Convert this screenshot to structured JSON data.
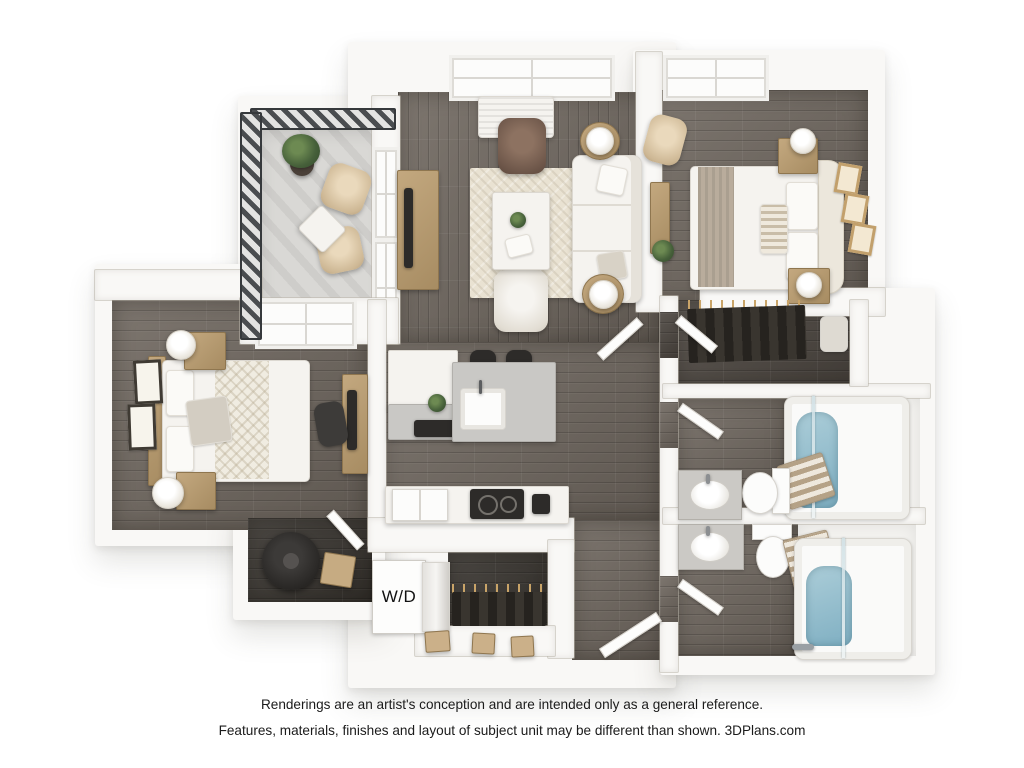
{
  "floor_plan": {
    "type": "3d-apartment-floor-plan-rendering",
    "labels": {
      "washer_dryer": "W/D"
    },
    "rooms": [
      "balcony",
      "living-room",
      "bedroom-1",
      "bedroom-2",
      "kitchen",
      "walk-in-closet",
      "bathroom-1",
      "bathroom-2",
      "laundry-closet",
      "storage-closet",
      "entry-hall"
    ],
    "colors": {
      "background": "#ffffff",
      "walls": "#f9f8f6",
      "wood_floor": "#6e665e",
      "closet_floor": "#38342f",
      "balcony_floor": "#d9d8d5",
      "rug": "#e9e2d2",
      "accent_wood": "#b79c74",
      "bath_water": "#8cb9c9",
      "railing": "#3b3e41",
      "counter_gray": "#c9c8c5"
    }
  },
  "footer": {
    "line1": "Renderings are an artist's conception and are intended only as a general reference.",
    "line2": "Features, materials, finishes and layout of subject unit may be different than shown. 3DPlans.com"
  }
}
